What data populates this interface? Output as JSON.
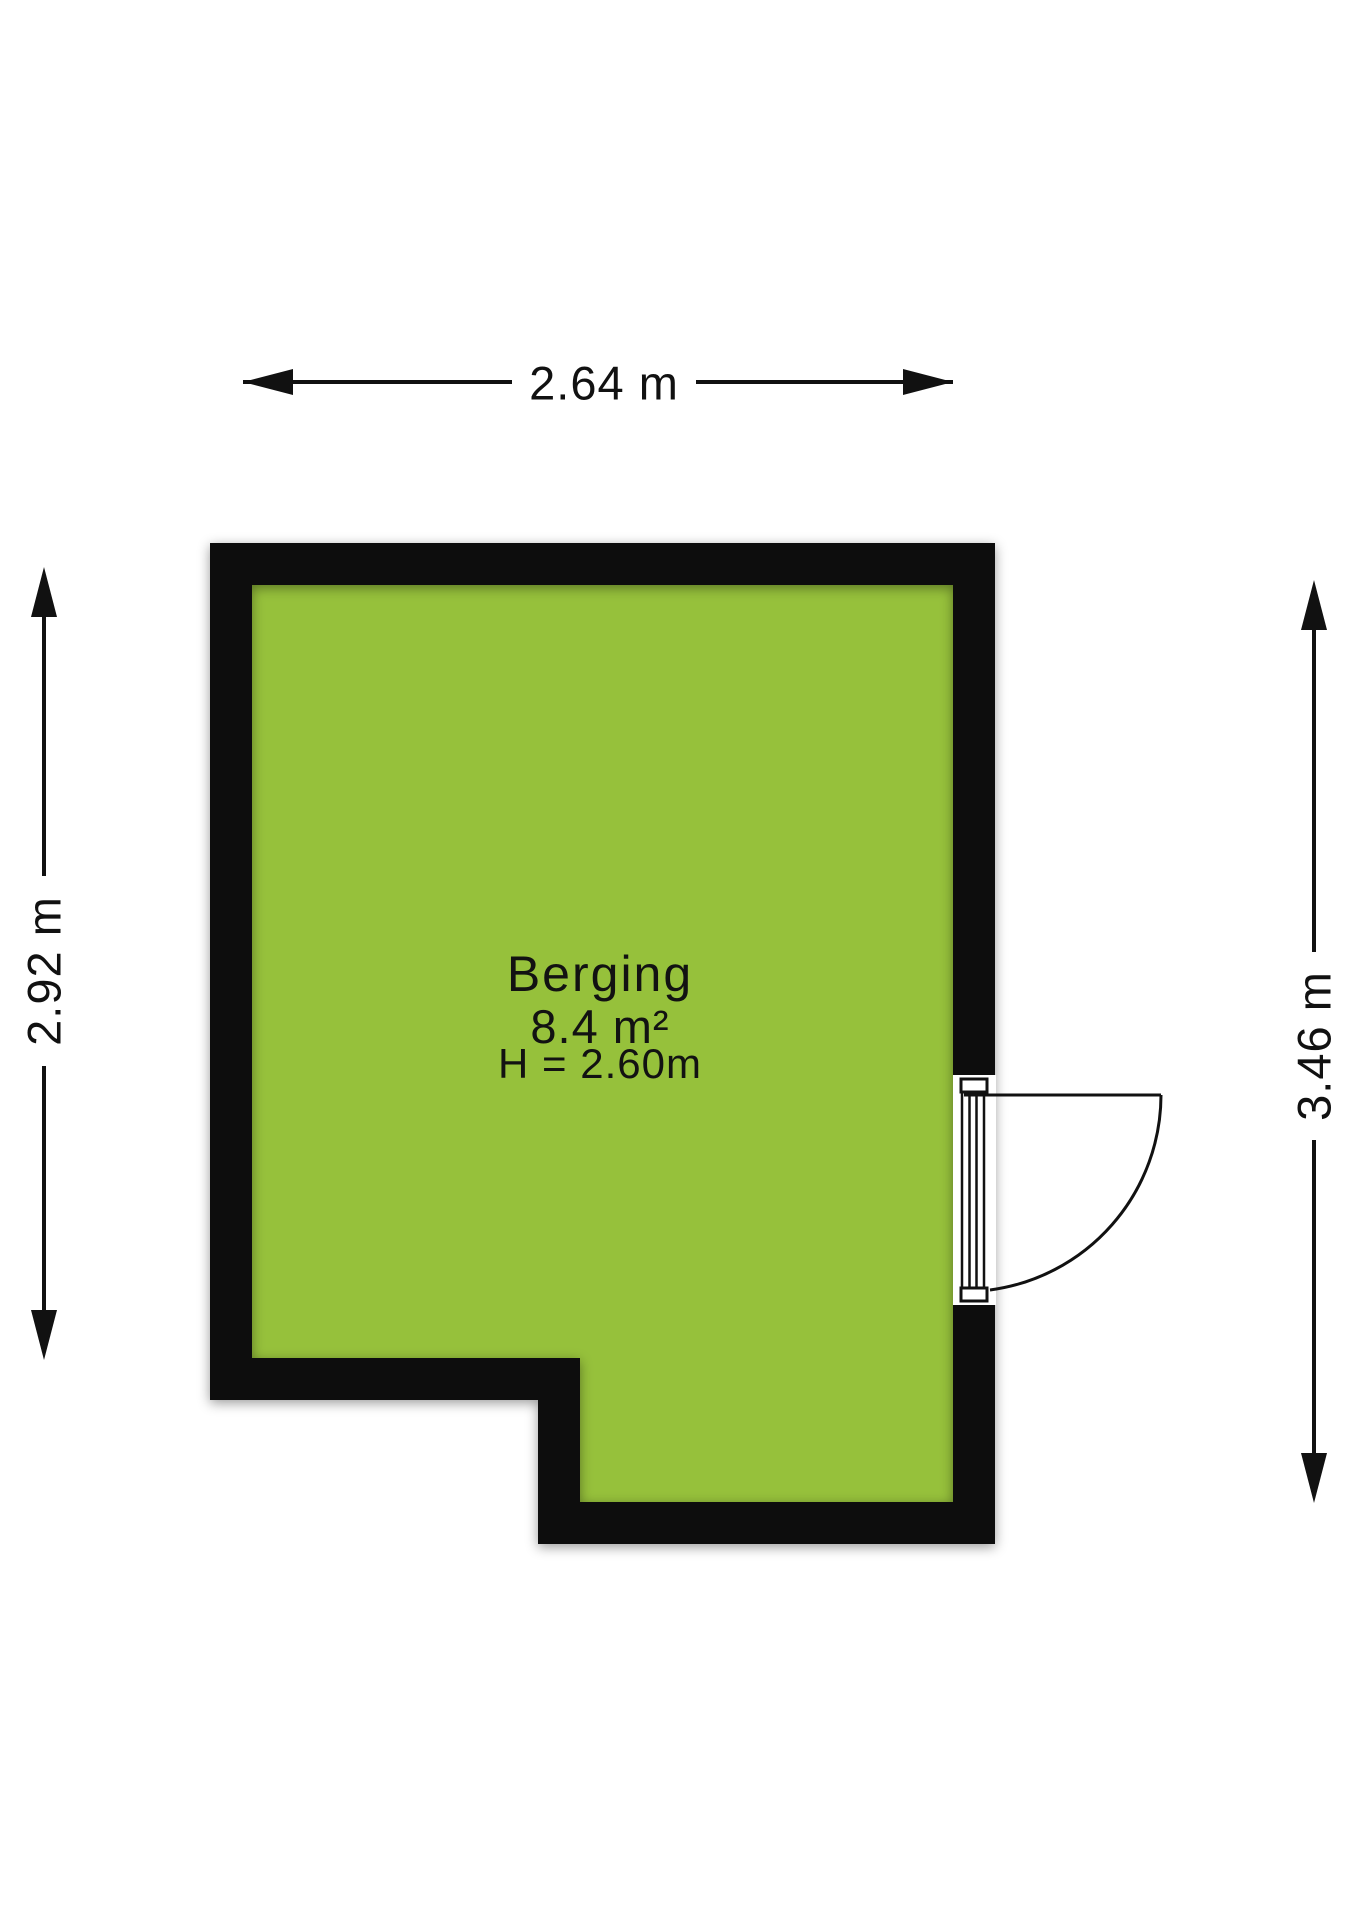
{
  "floorplan": {
    "room": {
      "name": "Berging",
      "area": "8.4 m²",
      "ceiling_height": "H = 2.60m"
    },
    "dimensions": {
      "top": "2.64 m",
      "left": "2.92 m",
      "right": "3.46 m"
    },
    "colors": {
      "floor": "#96C13B",
      "wall": "#0D0D0D"
    }
  }
}
